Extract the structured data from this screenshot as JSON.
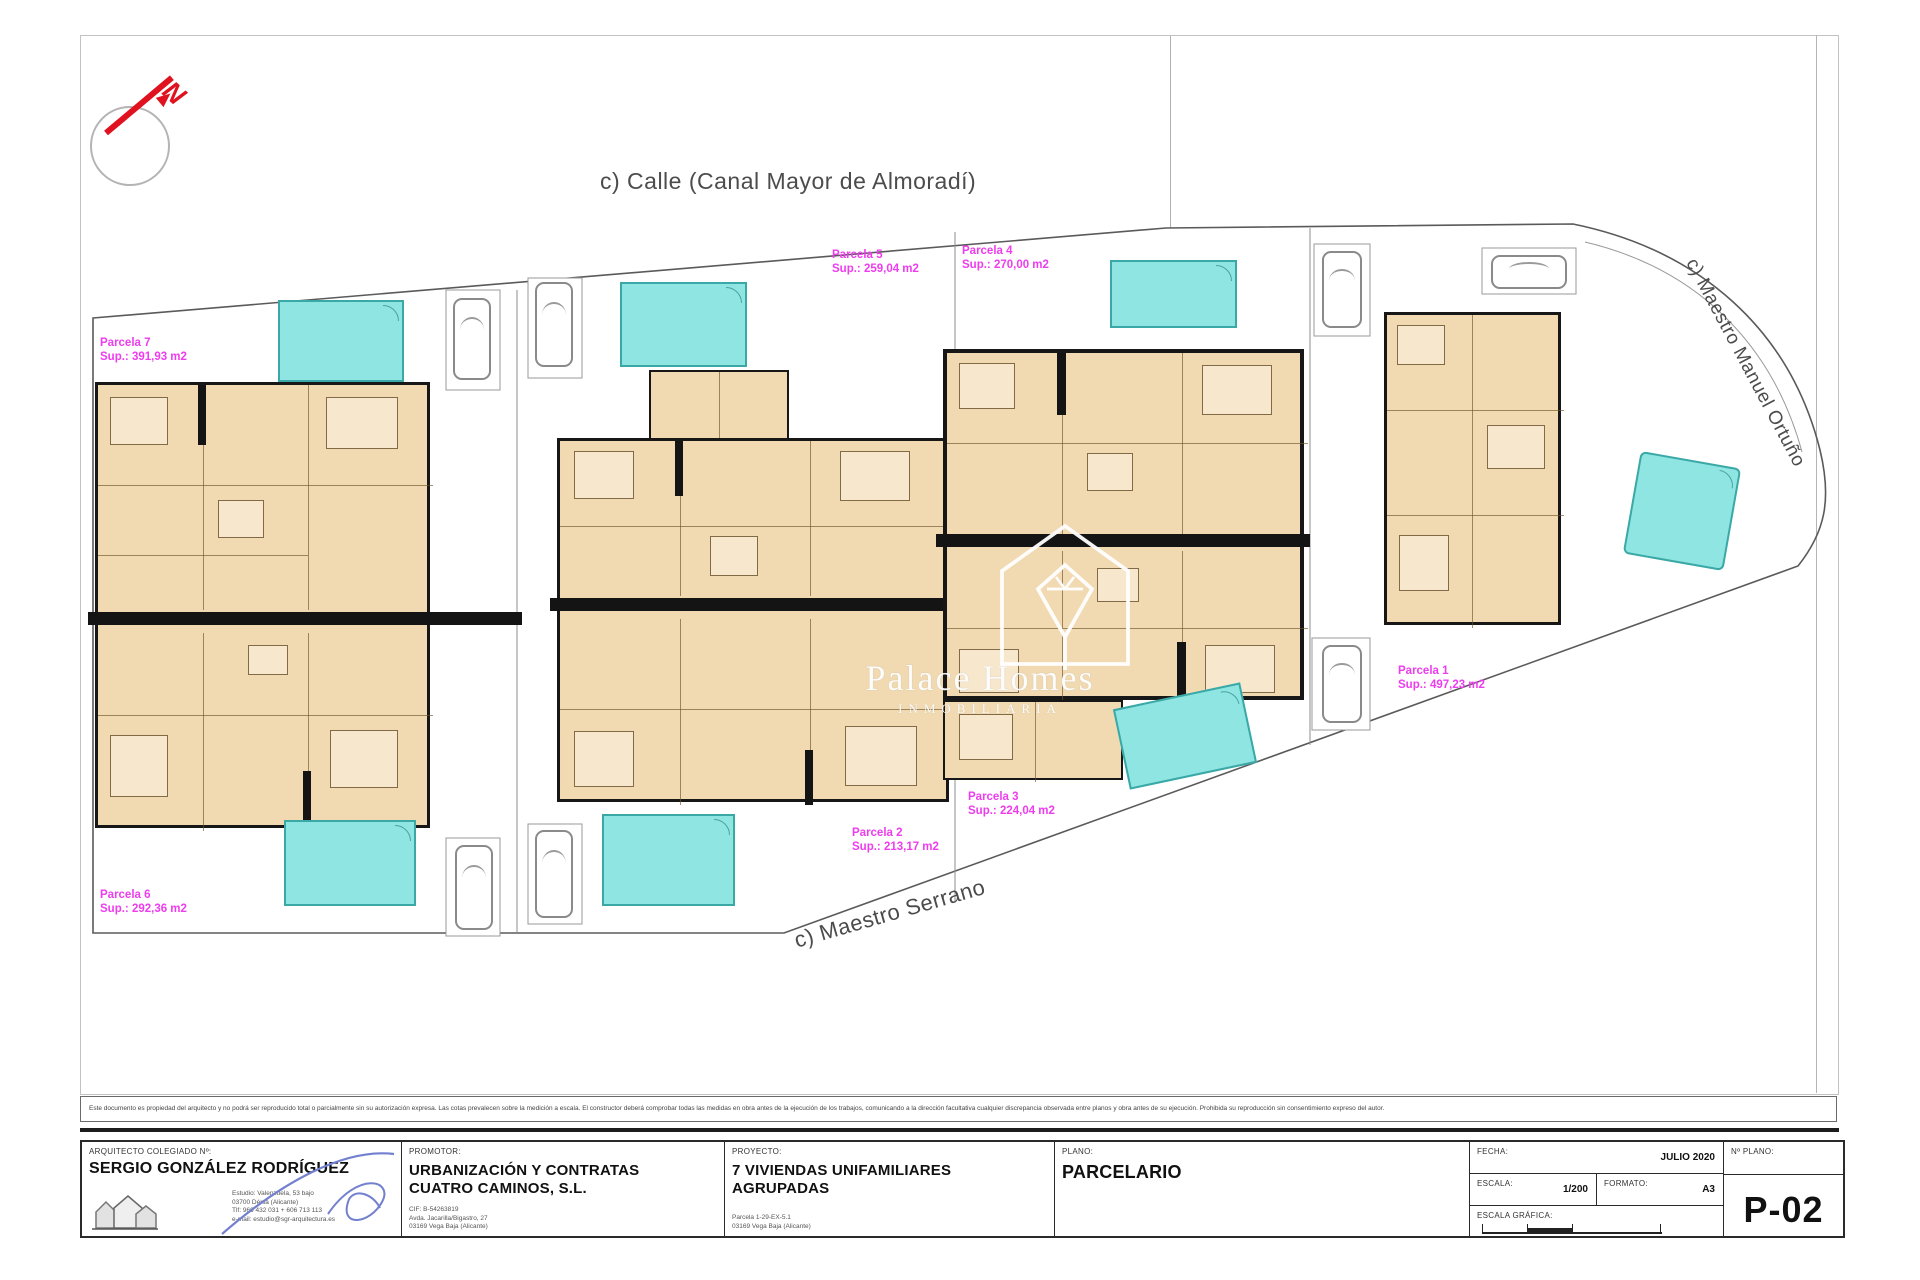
{
  "north_label": "N",
  "streets": {
    "top": "c) Calle (Canal Mayor de Almoradí)",
    "right": "c) Maestro Manuel Ortuño",
    "bottom": "c) Maestro Serrano"
  },
  "watermark": {
    "line1": "Palace Homes",
    "line2": "INMOBILIARIA"
  },
  "parcels": [
    {
      "name": "Parcela 7",
      "area": "Sup.: 391,93 m2"
    },
    {
      "name": "Parcela 5",
      "area": "Sup.: 259,04 m2"
    },
    {
      "name": "Parcela 4",
      "area": "Sup.: 270,00 m2"
    },
    {
      "name": "Parcela 1",
      "area": "Sup.: 497,23 m2"
    },
    {
      "name": "Parcela 3",
      "area": "Sup.: 224,04 m2"
    },
    {
      "name": "Parcela 2",
      "area": "Sup.: 213,17 m2"
    },
    {
      "name": "Parcela 6",
      "area": "Sup.: 292,36 m2"
    }
  ],
  "disclaimer": "Este documento es propiedad del arquitecto y no podrá ser reproducido total o parcialmente sin su autorización expresa. Las cotas prevalecen sobre la medición a escala. El constructor deberá comprobar todas las medidas en obra antes de la ejecución de los trabajos, comunicando a la dirección facultativa cualquier discrepancia observada entre planos y obra antes de su ejecución. Prohibida su reproducción sin consentimiento expreso del autor.",
  "title_block": {
    "architect": {
      "label": "ARQUITECTO COLEGIADO Nº:",
      "name": "SERGIO GONZÁLEZ RODRÍGUEZ",
      "contact1": "Estudio: Valenzuela, 53 bajo",
      "contact2": "03700 Dénia (Alicante)",
      "contact3": "Tlf: 966 432 031 + 606 713 113",
      "contact4": "e-mail: estudio@sgr-arquitectura.es"
    },
    "promoter": {
      "label": "PROMOTOR:",
      "name1": "URBANIZACIÓN Y CONTRATAS",
      "name2": "CUATRO CAMINOS, S.L.",
      "line1": "CIF: B-54263819",
      "line2": "Avda. Jacarilla/Bigastro, 27",
      "line3": "03169 Vega Baja (Alicante)"
    },
    "project": {
      "label": "PROYECTO:",
      "name1": "7 VIVIENDAS UNIFAMILIARES",
      "name2": "AGRUPADAS",
      "line1": "Parcela 1-29-EX-5.1",
      "line2": "03169 Vega Baja (Alicante)"
    },
    "plan": {
      "label": "PLANO:",
      "name": "PARCELARIO"
    },
    "meta": {
      "fecha_label": "FECHA:",
      "fecha": "JULIO 2020",
      "escala_label": "ESCALA:",
      "escala": "1/200",
      "formato_label": "FORMATO:",
      "formato": "A3",
      "grafica_label": "ESCALA GRÁFICA:",
      "nplano_label": "Nº PLANO:",
      "nplano": "P-02"
    }
  },
  "colors": {
    "floor_beige": "#f1dab2",
    "pool_cyan": "#8fe5e1",
    "parcel_magenta": "#ee3cee",
    "north_red": "#e0121f"
  }
}
